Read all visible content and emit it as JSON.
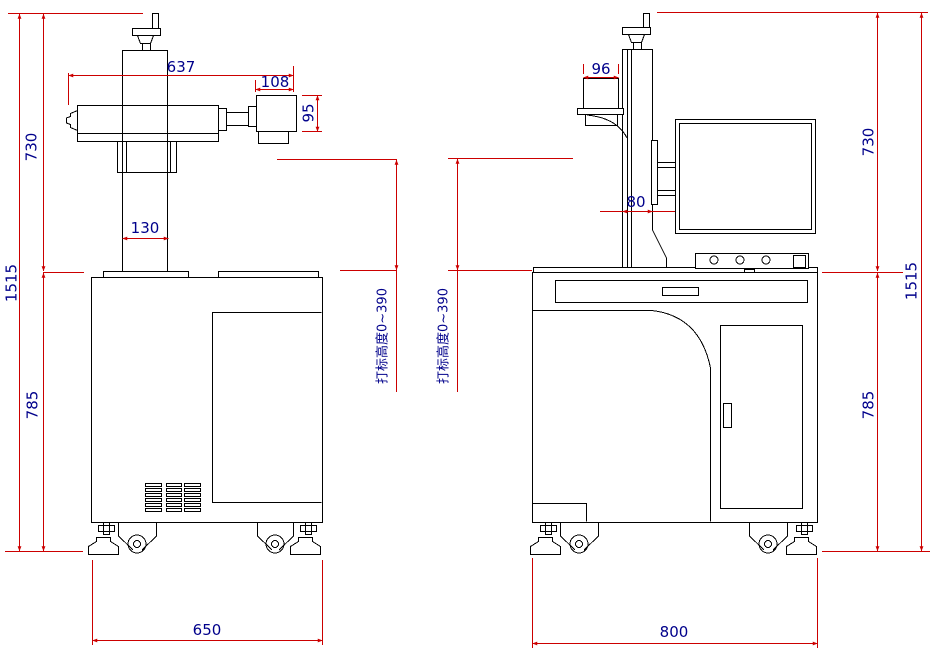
{
  "drawing": {
    "title": "laser-marking-machine-dimension-drawing",
    "background": "#ffffff",
    "machine_line_color": "#000000",
    "dimension_line_color": "#cc0000",
    "dimension_text_color": "#00008b",
    "front_view": {
      "label_total_height": "1515",
      "label_upper_height": "730",
      "label_cabinet_height": "785",
      "label_assembly_length": "637",
      "label_head_width": "108",
      "label_head_height": "95",
      "label_column_width": "130",
      "label_base_width": "650",
      "label_marking_height": "打标高度0~390"
    },
    "side_view": {
      "label_total_height": "1515",
      "label_upper_height": "730",
      "label_cabinet_height": "785",
      "label_head_depth": "96",
      "label_column_depth": "80",
      "label_base_depth": "800",
      "label_marking_height": "打标高度0~390"
    }
  }
}
